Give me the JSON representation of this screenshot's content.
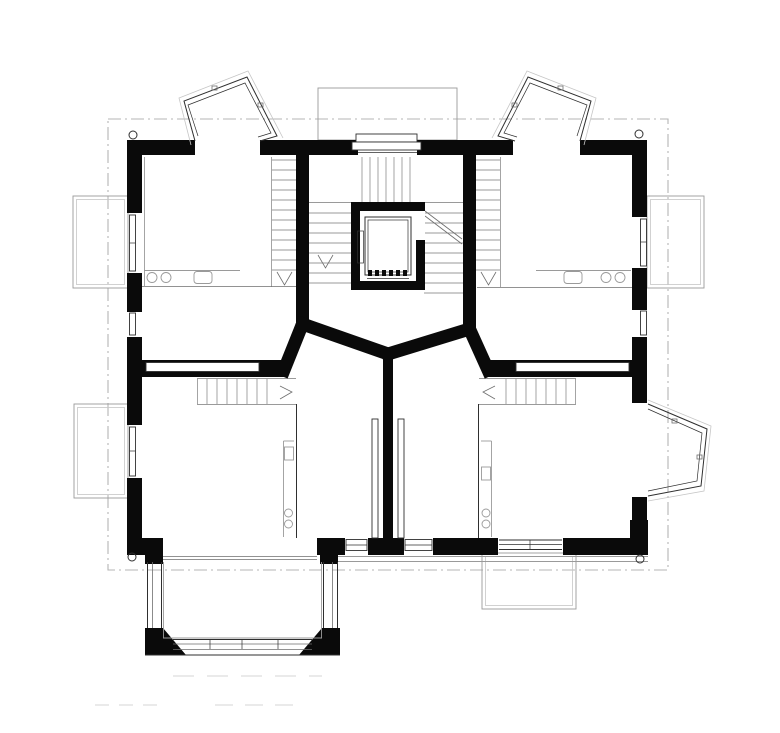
{
  "document": {
    "kind": "architectural-floor-plan",
    "visible_text": "",
    "background": "#ffffff"
  },
  "palette": {
    "paper": "#ffffff",
    "wall": "#0a0a0a",
    "detail": "#2f2f2f",
    "medium": "#6e6e6e",
    "light": "#9a9a9a",
    "faint": "#c6c6c6",
    "dash": "#b5b5b5"
  },
  "canvas": {
    "width": 780,
    "height": 733
  }
}
